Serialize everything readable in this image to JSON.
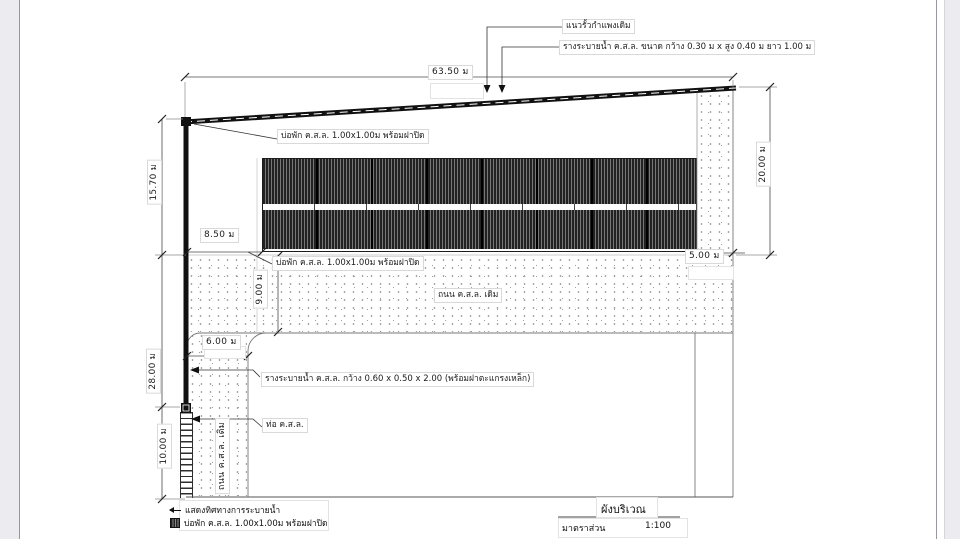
{
  "drawing": {
    "title": "ผังบริเวณ",
    "scale_label": "มาตราส่วน",
    "scale_value": "1:100"
  },
  "callouts": {
    "fence": "แนวรั้วกำแพงเดิม",
    "top_drain": "รางระบายน้ำ ค.ส.ล.  ขนาด  กว้าง 0.30  ม  x  สูง 0.40  ม  ยาว 1.00  ม",
    "manhole": "บ่อพัก  ค.ส.ล.  1.00x1.00ม  พร้อมฝาปิด",
    "existing_road": "ถนน  ค.ส.ล.  เดิม",
    "side_drain": "รางระบายน้ำ ค.ส.ล. กว้าง 0.60  x  0.50  x  2.00  (พร้อมฝาตะแกรงเหล็ก)",
    "pipe": "ท่อ  ค.ส.ล."
  },
  "dimensions": {
    "top_width": "63.50  ม",
    "right_height": "20.00  ม",
    "right_strip": "5.00  ม",
    "left_upper": "15.70  ม",
    "left_mid": "28.00  ม",
    "left_lower": "10.00  ม",
    "offset": "8.50  ม",
    "road_width": "9.00  ม",
    "entrance_width": "6.00  ม"
  },
  "legend": {
    "flow_label": "แสดงทิศทางการระบายน้ำ",
    "manhole_label": "บ่อพัก  ค.ส.ล.  1.00x1.00ม  พร้อมฝาปิด"
  },
  "colors": {
    "line": "#3a3a3a",
    "heavy": "#111111",
    "hatch_dark": "#222222",
    "stipple_dot": "#8b8b8b",
    "gutter": "#ececf0"
  }
}
